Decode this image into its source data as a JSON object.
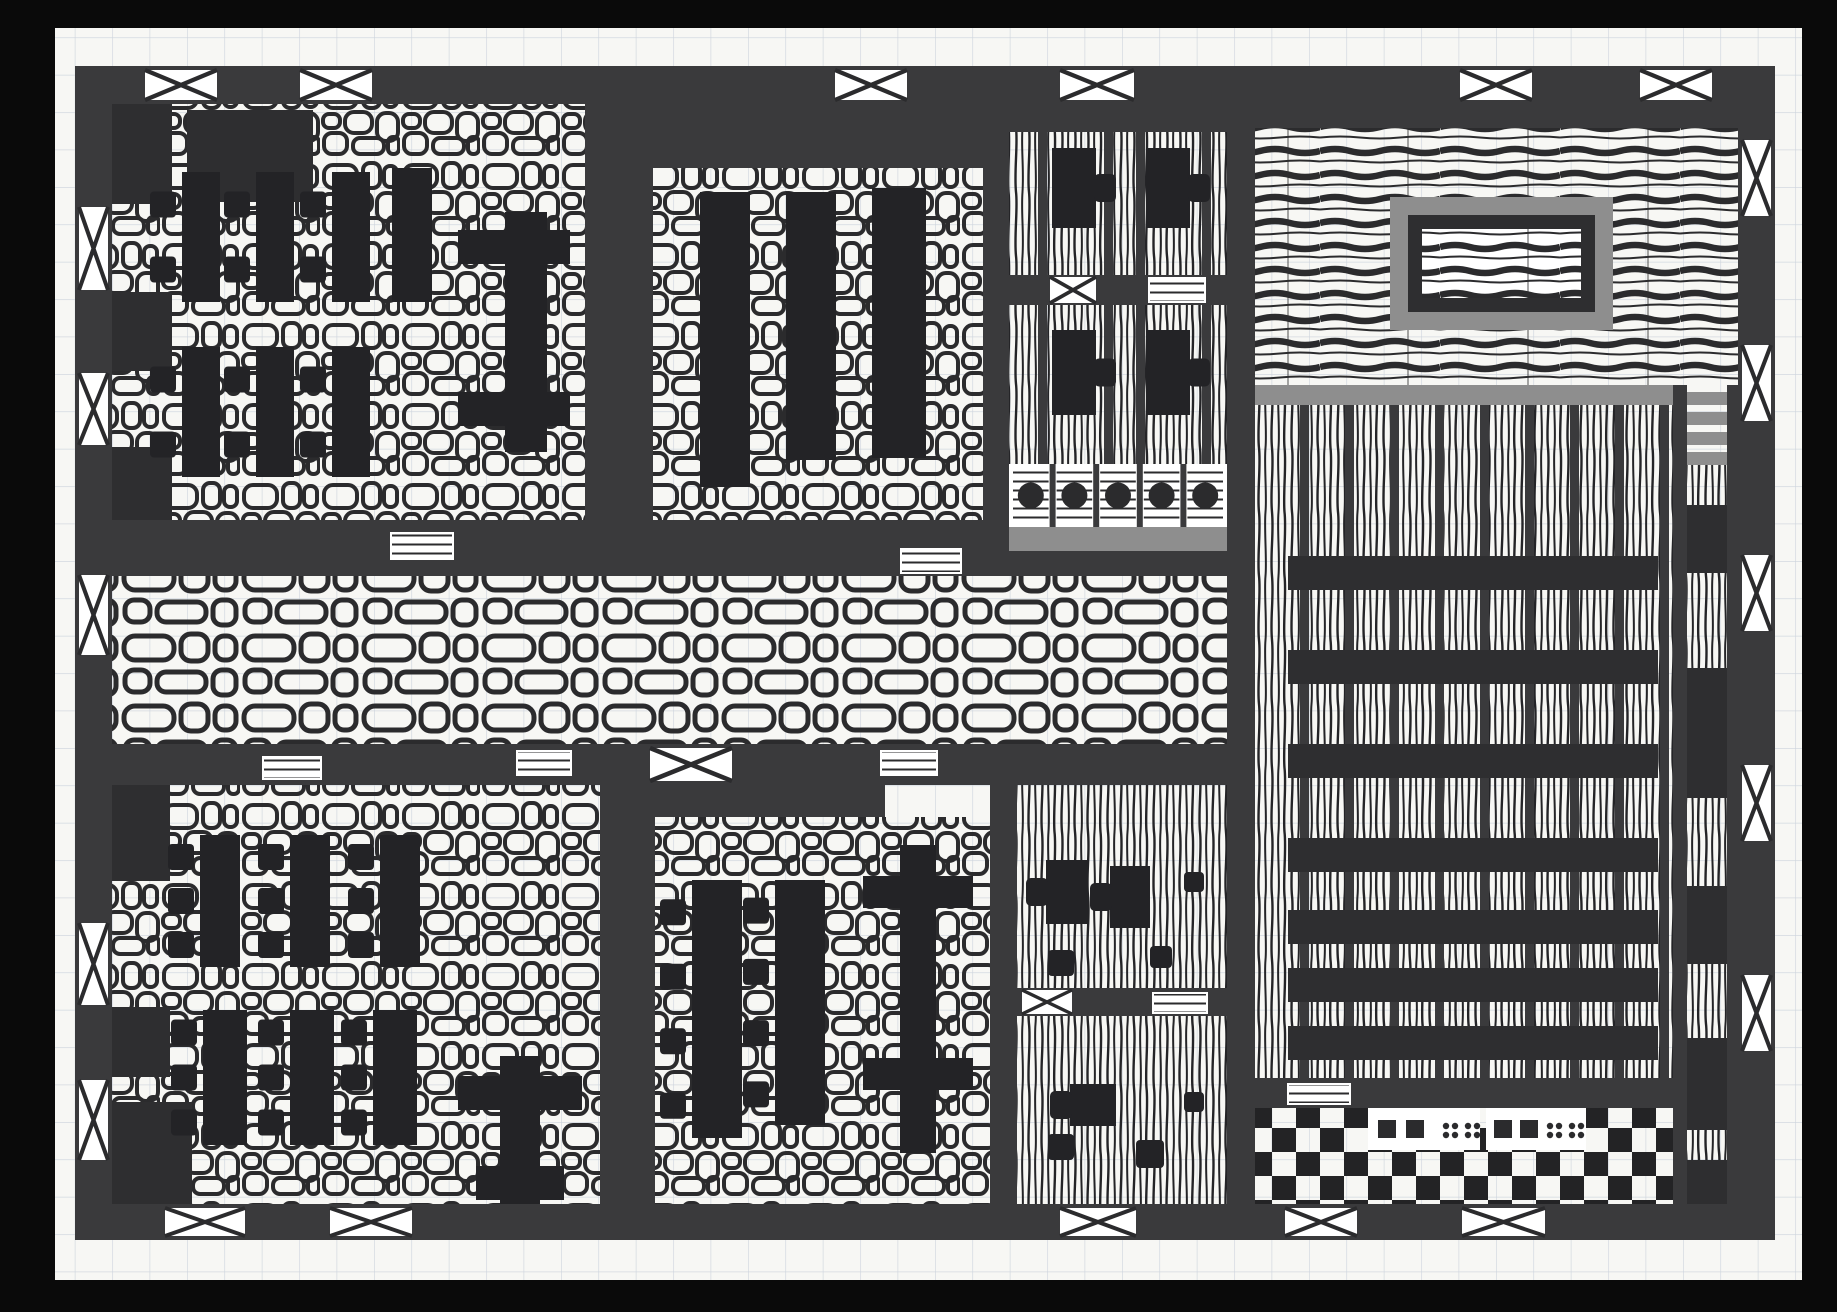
{
  "scene": {
    "kind": "hand-drawn building floor plan, black ink on graph paper (scanned)",
    "colors": {
      "scan_border": "#0a0a0a",
      "paper": "#f7f7f4",
      "grid": "#ccd3dc",
      "ink": "#2b2b2d",
      "wall": "#3a3a3c",
      "wall_dark": "#2e2e30",
      "furniture": "#232326",
      "gray_accent": "#8e8e8e",
      "white": "#ffffff"
    },
    "canvas": {
      "w": 1837,
      "h": 1312
    },
    "paper": {
      "x": 55,
      "y": 28,
      "w": 1747,
      "h": 1252,
      "grid_step": 37.4
    },
    "building": {
      "x": 75,
      "y": 66,
      "w": 1700,
      "h": 1174,
      "wall_thickness": 37
    },
    "rooms": [
      {
        "name": "hall-northwest",
        "x": 112,
        "y": 104,
        "w": 473,
        "h": 416,
        "floor": "cobble-small"
      },
      {
        "name": "hall-north-middle",
        "x": 653,
        "y": 168,
        "w": 330,
        "h": 352,
        "floor": "cobble-small"
      },
      {
        "name": "bar-room-north",
        "x": 1009,
        "y": 132,
        "w": 218,
        "h": 332,
        "floor": "hatch-v"
      },
      {
        "name": "stage-room-northeast",
        "x": 1255,
        "y": 128,
        "w": 483,
        "h": 257,
        "floor": "planks-h"
      },
      {
        "name": "great-hall-east",
        "x": 1255,
        "y": 405,
        "w": 418,
        "h": 673,
        "floor": "hatch-v"
      },
      {
        "name": "corridor-central",
        "x": 112,
        "y": 576,
        "w": 1115,
        "h": 168,
        "floor": "cobble-large"
      },
      {
        "name": "hall-southwest",
        "x": 112,
        "y": 785,
        "w": 488,
        "h": 419,
        "floor": "cobble-small"
      },
      {
        "name": "hall-south-middle",
        "x": 655,
        "y": 817,
        "w": 335,
        "h": 387,
        "floor": "cobble-small"
      },
      {
        "name": "cabinet-south",
        "x": 1017,
        "y": 785,
        "w": 210,
        "h": 419,
        "floor": "hatch-v"
      },
      {
        "name": "corridor-east",
        "x": 1687,
        "y": 460,
        "w": 40,
        "h": 744,
        "floor": "hatch-v"
      },
      {
        "name": "checker-room-southeast",
        "x": 1255,
        "y": 1108,
        "w": 418,
        "h": 96,
        "floor": "checker"
      }
    ],
    "walls": [
      {
        "x": 75,
        "y": 66,
        "w": 1700,
        "h": 38
      },
      {
        "x": 75,
        "y": 1204,
        "w": 1700,
        "h": 36
      },
      {
        "x": 75,
        "y": 66,
        "w": 37,
        "h": 1174
      },
      {
        "x": 1738,
        "y": 66,
        "w": 37,
        "h": 1174
      },
      {
        "x": 585,
        "y": 66,
        "w": 68,
        "h": 458
      },
      {
        "x": 75,
        "y": 520,
        "w": 934,
        "h": 56
      },
      {
        "x": 75,
        "y": 744,
        "w": 1152,
        "h": 41
      },
      {
        "x": 983,
        "y": 66,
        "w": 26,
        "h": 454
      },
      {
        "x": 1227,
        "y": 66,
        "w": 28,
        "h": 1138
      },
      {
        "x": 990,
        "y": 785,
        "w": 27,
        "h": 419
      },
      {
        "x": 600,
        "y": 744,
        "w": 55,
        "h": 460
      },
      {
        "x": 600,
        "y": 785,
        "w": 285,
        "h": 32
      },
      {
        "x": 1673,
        "y": 385,
        "w": 14,
        "h": 819
      },
      {
        "x": 1727,
        "y": 385,
        "w": 11,
        "h": 819
      },
      {
        "x": 1255,
        "y": 1078,
        "w": 418,
        "h": 30
      },
      {
        "x": 1009,
        "y": 275,
        "w": 218,
        "h": 30
      },
      {
        "x": 1017,
        "y": 988,
        "w": 210,
        "h": 28
      },
      {
        "x": 1009,
        "y": 104,
        "w": 218,
        "h": 28
      },
      {
        "x": 1255,
        "y": 104,
        "w": 483,
        "h": 24
      },
      {
        "x": 653,
        "y": 104,
        "w": 330,
        "h": 64
      },
      {
        "x": 1009,
        "y": 551,
        "w": 246,
        "h": 25
      }
    ],
    "pillars": [
      {
        "x": 112,
        "y": 104,
        "w": 60,
        "h": 100
      },
      {
        "x": 112,
        "y": 292,
        "w": 60,
        "h": 79
      },
      {
        "x": 112,
        "y": 447,
        "w": 60,
        "h": 73
      },
      {
        "x": 187,
        "y": 110,
        "w": 126,
        "h": 92
      },
      {
        "x": 112,
        "y": 785,
        "w": 58,
        "h": 96
      },
      {
        "x": 112,
        "y": 1007,
        "w": 58,
        "h": 70
      },
      {
        "x": 112,
        "y": 1102,
        "w": 80,
        "h": 102
      }
    ],
    "windows_exterior": [
      {
        "x": 145,
        "y": 70,
        "w": 72,
        "h": 30
      },
      {
        "x": 300,
        "y": 70,
        "w": 72,
        "h": 30
      },
      {
        "x": 835,
        "y": 70,
        "w": 72,
        "h": 30
      },
      {
        "x": 1060,
        "y": 70,
        "w": 74,
        "h": 30
      },
      {
        "x": 1460,
        "y": 70,
        "w": 72,
        "h": 30
      },
      {
        "x": 1640,
        "y": 70,
        "w": 72,
        "h": 30
      },
      {
        "x": 165,
        "y": 1208,
        "w": 80,
        "h": 28
      },
      {
        "x": 330,
        "y": 1208,
        "w": 82,
        "h": 28
      },
      {
        "x": 1060,
        "y": 1208,
        "w": 76,
        "h": 28
      },
      {
        "x": 1285,
        "y": 1208,
        "w": 72,
        "h": 28
      },
      {
        "x": 1462,
        "y": 1208,
        "w": 83,
        "h": 28
      },
      {
        "x": 79,
        "y": 207,
        "w": 29,
        "h": 83
      },
      {
        "x": 79,
        "y": 373,
        "w": 29,
        "h": 72
      },
      {
        "x": 79,
        "y": 575,
        "w": 29,
        "h": 80
      },
      {
        "x": 79,
        "y": 923,
        "w": 29,
        "h": 82
      },
      {
        "x": 79,
        "y": 1080,
        "w": 29,
        "h": 80
      },
      {
        "x": 1742,
        "y": 140,
        "w": 29,
        "h": 76
      },
      {
        "x": 1742,
        "y": 345,
        "w": 29,
        "h": 76
      },
      {
        "x": 1742,
        "y": 555,
        "w": 29,
        "h": 76
      },
      {
        "x": 1742,
        "y": 765,
        "w": 29,
        "h": 76
      },
      {
        "x": 1742,
        "y": 975,
        "w": 29,
        "h": 76
      }
    ],
    "windows_interior": [
      {
        "x": 650,
        "y": 748,
        "w": 82,
        "h": 33
      },
      {
        "x": 1050,
        "y": 277,
        "w": 46,
        "h": 26
      },
      {
        "x": 1022,
        "y": 990,
        "w": 50,
        "h": 24
      }
    ],
    "vents": [
      {
        "x": 390,
        "y": 532,
        "w": 64,
        "h": 28
      },
      {
        "x": 900,
        "y": 548,
        "w": 62,
        "h": 26
      },
      {
        "x": 516,
        "y": 750,
        "w": 56,
        "h": 26
      },
      {
        "x": 880,
        "y": 750,
        "w": 58,
        "h": 26
      },
      {
        "x": 1148,
        "y": 277,
        "w": 58,
        "h": 26
      },
      {
        "x": 1152,
        "y": 992,
        "w": 56,
        "h": 22
      },
      {
        "x": 1287,
        "y": 1083,
        "w": 64,
        "h": 22
      },
      {
        "x": 262,
        "y": 756,
        "w": 60,
        "h": 24
      }
    ],
    "bar_tables": [
      {
        "x": 182,
        "y": 172,
        "w": 38,
        "h": 130,
        "stools": 2
      },
      {
        "x": 256,
        "y": 172,
        "w": 38,
        "h": 130,
        "stools": 2
      },
      {
        "x": 332,
        "y": 172,
        "w": 38,
        "h": 130,
        "stools": 2
      },
      {
        "x": 392,
        "y": 168,
        "w": 40,
        "h": 134,
        "stools": 0
      },
      {
        "x": 182,
        "y": 347,
        "w": 38,
        "h": 130,
        "stools": 2
      },
      {
        "x": 256,
        "y": 347,
        "w": 38,
        "h": 130,
        "stools": 2
      },
      {
        "x": 332,
        "y": 347,
        "w": 38,
        "h": 130,
        "stools": 2
      },
      {
        "x": 700,
        "y": 192,
        "w": 50,
        "h": 295,
        "stools": 0
      },
      {
        "x": 786,
        "y": 192,
        "w": 50,
        "h": 268,
        "stools": 0
      },
      {
        "x": 872,
        "y": 188,
        "w": 54,
        "h": 270,
        "stools": 0
      },
      {
        "x": 200,
        "y": 835,
        "w": 40,
        "h": 132,
        "stools": 3
      },
      {
        "x": 290,
        "y": 835,
        "w": 40,
        "h": 132,
        "stools": 3
      },
      {
        "x": 380,
        "y": 835,
        "w": 40,
        "h": 132,
        "stools": 3
      },
      {
        "x": 203,
        "y": 1010,
        "w": 44,
        "h": 135,
        "stools": 3
      },
      {
        "x": 290,
        "y": 1010,
        "w": 44,
        "h": 135,
        "stools": 3
      },
      {
        "x": 373,
        "y": 1010,
        "w": 44,
        "h": 135,
        "stools": 3
      },
      {
        "x": 692,
        "y": 880,
        "w": 50,
        "h": 258,
        "stools": 4
      },
      {
        "x": 775,
        "y": 880,
        "w": 50,
        "h": 245,
        "stools": 4
      }
    ],
    "cross_tables": [
      {
        "bar": {
          "x": 505,
          "y": 212,
          "w": 42,
          "h": 240
        },
        "arms": [
          {
            "x": 458,
            "y": 230,
            "w": 112,
            "h": 34
          },
          {
            "x": 458,
            "y": 392,
            "w": 112,
            "h": 34
          }
        ]
      },
      {
        "bar": {
          "x": 500,
          "y": 1056,
          "w": 40,
          "h": 148
        },
        "arms": [
          {
            "x": 458,
            "y": 1076,
            "w": 124,
            "h": 34
          },
          {
            "x": 476,
            "y": 1166,
            "w": 88,
            "h": 34
          }
        ]
      },
      {
        "bar": {
          "x": 900,
          "y": 845,
          "w": 36,
          "h": 308
        },
        "arms": [
          {
            "x": 863,
            "y": 876,
            "w": 110,
            "h": 32
          },
          {
            "x": 863,
            "y": 1058,
            "w": 110,
            "h": 32
          }
        ]
      }
    ],
    "tab_tables": [
      {
        "x": 1052,
        "y": 148,
        "w": 44,
        "h": 80,
        "side": "right"
      },
      {
        "x": 1146,
        "y": 148,
        "w": 44,
        "h": 80,
        "side": "right"
      },
      {
        "x": 1052,
        "y": 330,
        "w": 44,
        "h": 85,
        "side": "right"
      },
      {
        "x": 1146,
        "y": 330,
        "w": 44,
        "h": 85,
        "side": "right"
      },
      {
        "x": 1046,
        "y": 860,
        "w": 42,
        "h": 64,
        "side": "left"
      },
      {
        "x": 1110,
        "y": 866,
        "w": 40,
        "h": 62,
        "side": "left"
      },
      {
        "x": 1070,
        "y": 1084,
        "w": 46,
        "h": 42,
        "side": "left"
      }
    ],
    "loose_stools": [
      {
        "x": 1048,
        "y": 950,
        "s": 26
      },
      {
        "x": 1150,
        "y": 946,
        "s": 22
      },
      {
        "x": 1048,
        "y": 1134,
        "s": 26
      },
      {
        "x": 1136,
        "y": 1140,
        "s": 28
      },
      {
        "x": 1184,
        "y": 872,
        "s": 20
      },
      {
        "x": 1184,
        "y": 1092,
        "s": 20
      }
    ],
    "bar_counter": {
      "stool_row": {
        "x": 1009,
        "y": 464,
        "w": 218,
        "h": 63,
        "cells": 5
      },
      "counter_gray": {
        "x": 1009,
        "y": 527,
        "w": 218,
        "h": 24
      }
    },
    "benches_east": {
      "x": 1288,
      "w": 370,
      "h": 34,
      "ys": [
        556,
        650,
        744,
        838,
        910,
        968,
        1026
      ]
    },
    "mullions_east": {
      "y": 405,
      "h": 673,
      "w": 9,
      "xs": [
        1300,
        1345,
        1390,
        1435,
        1480,
        1525,
        1570,
        1615,
        1660
      ]
    },
    "mullions_bar": {
      "y": 132,
      "h": 332,
      "w": 9,
      "xs": [
        1038,
        1104,
        1136,
        1202
      ]
    },
    "gray_bands": [
      {
        "x": 1255,
        "y": 385,
        "w": 418,
        "h": 20
      }
    ],
    "stairs_east": {
      "x": 1687,
      "y": 392,
      "w": 40,
      "bar_h": 13,
      "gap": 7,
      "count": 4
    },
    "corridor_blocks": [
      {
        "x": 1687,
        "y": 505,
        "w": 40,
        "h": 68
      },
      {
        "x": 1687,
        "y": 668,
        "w": 40,
        "h": 130
      },
      {
        "x": 1687,
        "y": 886,
        "w": 40,
        "h": 78
      },
      {
        "x": 1687,
        "y": 1038,
        "w": 40,
        "h": 92
      },
      {
        "x": 1687,
        "y": 1160,
        "w": 40,
        "h": 44
      }
    ],
    "stage": {
      "outer": {
        "x": 1390,
        "y": 197,
        "w": 223,
        "h": 133
      },
      "mid": {
        "x": 1408,
        "y": 215,
        "w": 187,
        "h": 97
      },
      "inner": {
        "x": 1422,
        "y": 229,
        "w": 159,
        "h": 69
      }
    },
    "domino_panels": [
      {
        "x": 1368,
        "y": 1108,
        "w": 112,
        "h": 42,
        "squares": [
          {
            "dx": 10,
            "dy": 12
          },
          {
            "dx": 38,
            "dy": 12
          }
        ],
        "dots": [
          {
            "dx": 78,
            "dy": 14
          },
          {
            "dx": 100,
            "dy": 14
          }
        ]
      },
      {
        "x": 1486,
        "y": 1108,
        "w": 100,
        "h": 42,
        "squares": [
          {
            "dx": 8,
            "dy": 12
          },
          {
            "dx": 34,
            "dy": 12
          }
        ],
        "dots": [
          {
            "dx": 64,
            "dy": 14
          },
          {
            "dx": 86,
            "dy": 14
          }
        ]
      }
    ]
  }
}
